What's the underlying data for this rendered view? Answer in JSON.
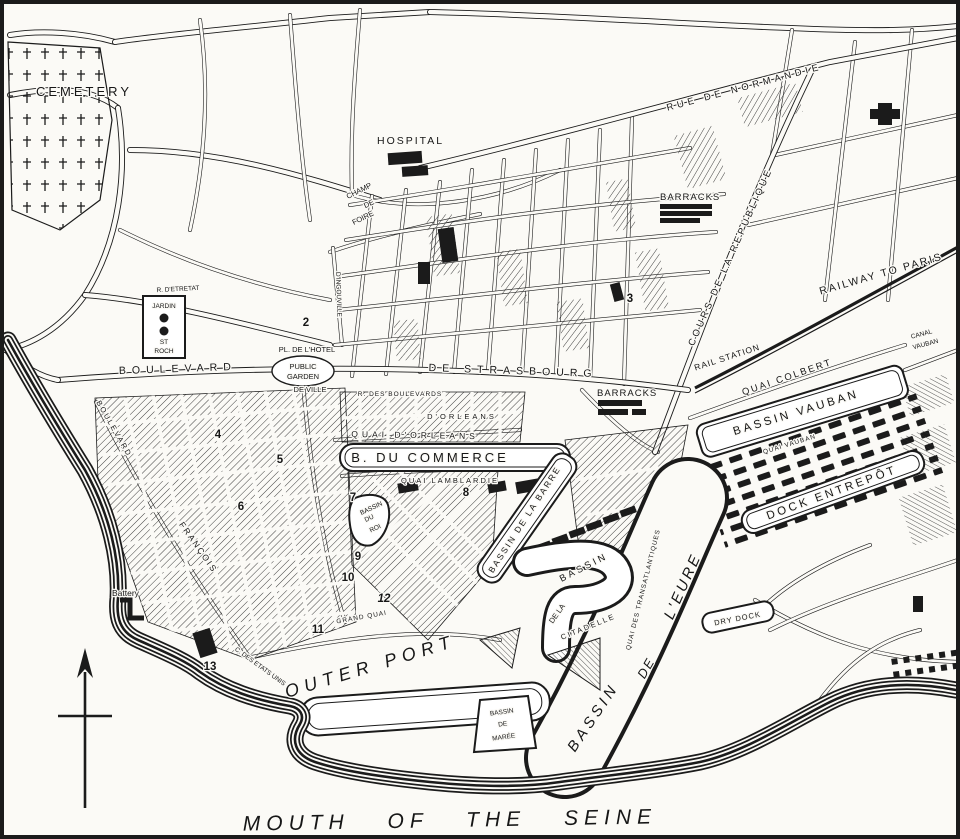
{
  "colors": {
    "ink": "#1b1b1b",
    "paper": "#fbfaf6"
  },
  "icons": {
    "compass": "north-arrow",
    "cemetery_symbol": "cross-markers",
    "garden_symbol": "tree-circles"
  },
  "labels": {
    "cemetery": "CEMETERY",
    "hospital": "HOSPITAL",
    "champ_de_foire": {
      "l1": "CHAMP",
      "l2": "DE",
      "l3": "FOIRE"
    },
    "barracks_north": "BARRACKS",
    "barracks_station": "BARRACKS",
    "rue_de_normandie": "RUE DE NORMANDIE",
    "cours_de_la_republique": "COURS DE LA REPUBLIQUE",
    "railway_to_paris": "RAILWAY TO PARIS",
    "rail_station": "RAIL STATION",
    "quai_colbert": "QUAI COLBERT",
    "bassin_vauban": "BASSIN VAUBAN",
    "quai_vauban": "QUAI VAUBAN",
    "canal_vauban": {
      "l1": "CANAL",
      "l2": "VAUBAN"
    },
    "dock_entrepot": "DOCK ENTREPÔT",
    "boulevard": "BOULEVARD",
    "de_strasbourg": "DE STRASBOURG",
    "jardin_st_roch": {
      "l1": "JARDIN",
      "l2": "ST",
      "l3": "ROCH"
    },
    "rue_detretat": "R. D'ETRETAT",
    "rue_dingouville": "D'INGOUVILLE",
    "pl_hotel_de_ville": {
      "l1": "PL. DE L'HOTEL",
      "l2": "DE VILLE"
    },
    "public_garden": {
      "l1": "PUBLIC",
      "l2": "GARDEN"
    },
    "des_boulevards": "R. DES BOULEVARDS",
    "rue_dorleans": "D'ORLEANS",
    "quai_dorleans": "QUAI D'ORLEANS",
    "bassin_du_commerce": "B. DU COMMERCE",
    "quai_lamblardie": "QUAI LAMBLARDIE",
    "bassin_du_roi": {
      "l1": "BASSIN",
      "l2": "DU",
      "l3": "ROI"
    },
    "bassin_de_la_barre": "BASSIN DE LA BARRE",
    "bassin_citadelle": {
      "l1": "BASSIN",
      "l2": "DE LA",
      "l3": "CITADELLE"
    },
    "quai_des_transatlantiques": "QUAI DES TRANSATLANTIQUES",
    "bassin_de_leure": {
      "l1": "BASSIN",
      "l2": "DE",
      "l3": "L'EURE"
    },
    "dry_dock": "DRY DOCK",
    "outer_port": "OUTER PORT",
    "bassin_de_maree": {
      "l1": "BASSIN",
      "l2": "DE",
      "l3": "MARÉE"
    },
    "battery": "Battery",
    "c_des_etats_unis": "C. DES ETATS UNIS",
    "grand_quai": "GRAND QUAI",
    "boulevard_francois": {
      "l1": "BOULEVARD",
      "l2": "FRANÇOIS"
    },
    "mouth_of_the_seine": "MOUTH OF THE SEINE"
  },
  "markers": [
    "2",
    "3",
    "4",
    "5",
    "6",
    "7",
    "8",
    "9",
    "10",
    "11",
    "12",
    "13"
  ]
}
